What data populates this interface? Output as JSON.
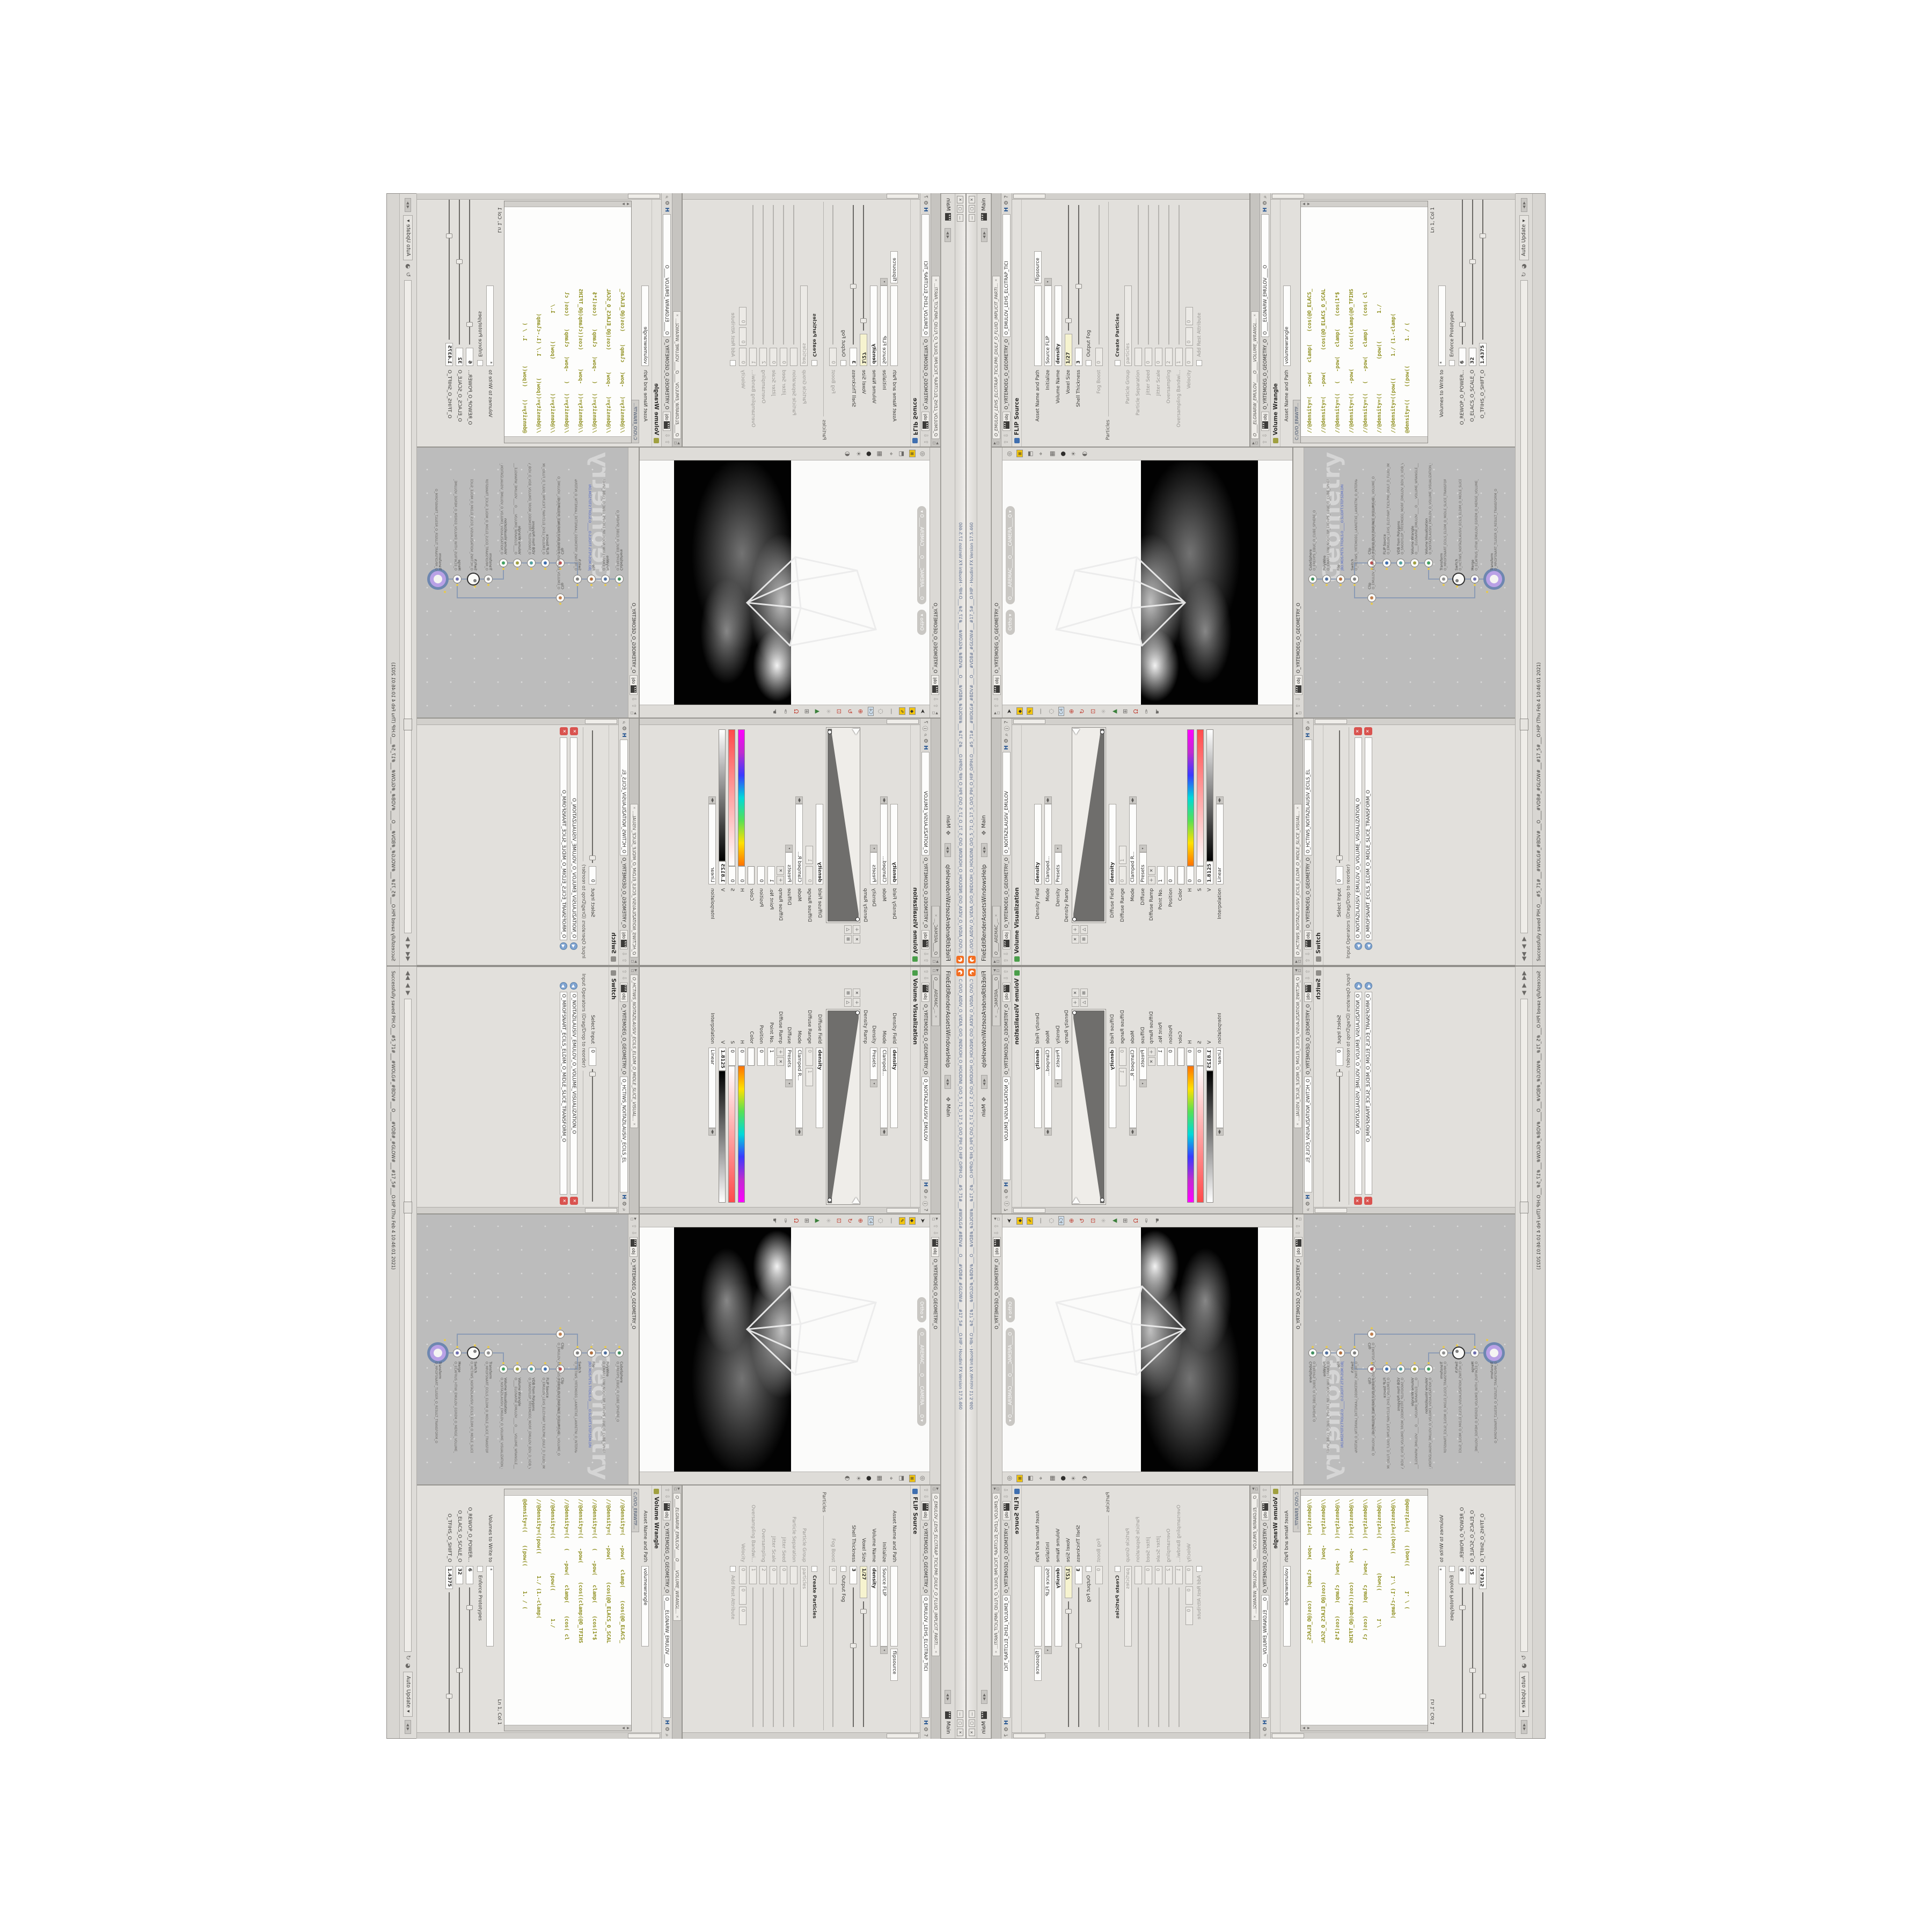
{
  "colors": {
    "accent_orange": "#f26d21",
    "node_purple": "#b9a1e6",
    "node_ring_blue": "#6e87b0",
    "code_text": "#8f8f1f",
    "yellow_field": "#f6f3cf",
    "title_text": "#5a6b8c",
    "network_bg": "#bcbcbc"
  },
  "window": {
    "title": "C:/O/O_AIDIV_O_VIDIA_O/O_INIDUOH_O_HOUDINI_O/O_5_71_O_17_5_O/O_PIH_O_HIP_O/PIH.O___#5_71#___#WOLG#_#BDV#___O___#VDB#_#GLOW#___#17_5#___O.HIP - Houdini FX Version 17.5.460",
    "menus": [
      "File",
      "Edit",
      "Render",
      "Assets",
      "Windows",
      "Help"
    ],
    "desktop_label": "Main",
    "take_label": "Main",
    "btn_min": "—",
    "btn_max": "▢",
    "btn_close": "✕"
  },
  "viz_pane": {
    "tabs": [
      "O____ARTNAM_...",
      "O____AREMAC_...",
      "O_NOITAZILAUSIV..."
    ],
    "context": "obj",
    "crumb": "O_YRTEMOEG_O_GEOMETRY_O",
    "pathfield": "O_NOITAZILAUSIV_EMULOV",
    "header": "Volume Visualization",
    "density_field_label": "Density Field",
    "density_field": "density",
    "mode_label": "Mode",
    "mode": "Clamped...",
    "density_label": "Density",
    "presets": "Presets",
    "density_ramp_label": "Density Ramp",
    "diffuse_field_label": "Diffuse Field",
    "diffuse_field": "density",
    "diffuse_range_label": "Diffuse Range",
    "diffuse_range_min": "0",
    "diffuse_range_max": "1",
    "mode2_label": "Mode",
    "mode2": "Clamped R...",
    "diffuse_label": "Diffuse",
    "presets2": "Presets",
    "diffuse_ramp_label": "Diffuse Ramp",
    "point_label": "Point No.",
    "point": "1",
    "position_label": "Position",
    "position": "0",
    "color_label": "Color",
    "h_label": "H",
    "h": "0",
    "s_label": "S",
    "s": "0",
    "v_label": "V",
    "v": "1.8125",
    "interp_label": "Interpolation",
    "interp": "Linear"
  },
  "switch_pane": {
    "tab": "O_HCTIWS_NOITAZILAUSIV_ECILS_ELDIM_O_MIDLE_SLICE_VISUAL...",
    "context": "obj",
    "crumb": "O_YRTEMOEG_O_GEOMETRY_O",
    "pathfield": "O_HCTIWS_NOITAZILAUSIV_ECILS_EL",
    "header": "Switch",
    "select_label": "Select Input",
    "select": "0",
    "ops_label": "Input Operators (Drag/Drop to reorder)",
    "items": [
      "O_NOITAZILAUSIV_EMULOV_O_VOLUME_VISUALIZATION_O",
      "O_MROFSNART_ECILS_ELDIM_O_MIDLE_SLICE_TRANSFORM_O"
    ]
  },
  "viewport": {
    "context": "obj",
    "crumb": "O_YRTEMOEG_O_GEOMETRY_O",
    "ortho_pill": "Ortho ▾",
    "camera_pill": "O____AREMAC____O____CAMERA____O ▾"
  },
  "network": {
    "context": "obj",
    "crumb": "O_YRTEMOEG_O_GEOMETRY_O",
    "watermark": "Geometry",
    "nodes": [
      {
        "style": "left:250px;top:8px",
        "cls": "node",
        "mini": "#3f8f5f",
        "type": "CubeSphere",
        "name": "O_EREHPS_EBUC_O_CUBE_SPHERE_O",
        "name_style": ""
      },
      {
        "style": "left:250px;top:34px",
        "cls": "node",
        "mini": "#4f6f9f",
        "type": "PolyWire",
        "name": "O_EMARFERIW_NOGYLOP_EREHPS_EBUC_O_CUBE_SPHERE_POLYGON_WIREFRAME_O",
        "name_style": ""
      },
      {
        "style": "left:250px;top:60px",
        "cls": "node",
        "mini": "#b06f3f",
        "type": "File",
        "name": "JBD.MDS.PETS.TFIDILS.O_____O.SLIDIFT.STEP.SDM.DRI",
        "name_style": "color:#4a62c8"
      },
      {
        "style": "left:250px;top:86px",
        "cls": "node",
        "mini": "#7f7f7f",
        "type": "Switch",
        "name": "O_HCTIWS_YRTEMOEG_LANRETXE_LANRETNI_O_INTERNAL_EXTERNAL_GEOMETRY_SWITCH_O",
        "name_style": ""
      },
      {
        "style": "left:280px;top:118px",
        "cls": "node",
        "mini": "#c05050",
        "type": "Clip",
        "name": "O_EMULOV_LEHS_PILC_O_CLIP_SHEL_VOLUME_O",
        "name_style": ""
      },
      {
        "style": "left:215px;top:118px",
        "cls": "node",
        "mini": "#c08050",
        "type": "Clip",
        "name": "O_EMULOV_ECAFRUS_PILC_O_CLIP_SURFACE_VOLUME_O",
        "name_style": ""
      },
      {
        "style": "left:280px;top:146px",
        "cls": "node",
        "mini": "#3f6fb0",
        "type": "FLIP Source",
        "name": "O_EMULOV_LEHS_ELCITRAP_TICILPMI_DIULF_D_FLUID_IMPLICIT_PARTICLE_SHEL_VOLUME_O",
        "name_style": ""
      },
      {
        "style": "left:280px;top:172px",
        "cls": "node",
        "mini": "#50a0a0",
        "type": "VDB from Polygons",
        "name": "O_SNOGYLOP_YRTEMOEG_MORF_EMULOV_BDV_D_VDB_VOLUME_FROM_GEOMETRY_POLYGONS_O",
        "name_style": ""
      },
      {
        "style": "left:280px;top:198px",
        "cls": "node",
        "mini": "#a0a040",
        "type": "Volume Wrangle",
        "name": "O____ELGNARW_EMULOV____O____VOLUME_WRANGLE____O2",
        "name_style": ""
      },
      {
        "style": "left:280px;top:224px",
        "cls": "node",
        "mini": "#40a060",
        "type": "Volume Visualization",
        "name": "O_NOITAZILAUSIV_EMULOV_O_VOLUME_VISUALIZATION_O",
        "name_style": ""
      },
      {
        "style": "left:250px;top:252px",
        "cls": "node",
        "mini": "#8f8f8f",
        "type": "Transform",
        "name": "O_MROFSNART_ECILS_ELDIM_O_MIDLE_SLICE_TRANSFORM_O",
        "name_style": ""
      },
      {
        "style": "left:250px;top:280px",
        "cls": "node ring",
        "mini": "#7f7f7f",
        "type": "Switch",
        "name": "O_HCTIWS_NOITAZILAUSIV_ECILS_ELDIM_O_MIDLE_SLICE_VISUALIZATION_SWITCH_O",
        "name_style": ""
      },
      {
        "style": "left:250px;top:310px",
        "cls": "node",
        "mini": "#6f6fb0",
        "type": "Merge",
        "name": "O_ECAFRUS_HTIW_EMULOV_EGREM_O_MERGE_VOLUME_WITH_SURFACE_O",
        "name_style": ""
      },
      {
        "style": "left:250px;top:346px",
        "cls": "node big",
        "mini": "",
        "type": "Transform",
        "name": "O_MROFSNART_TLUSER_O_RESULT_TRANSFORM_O",
        "name_style": ""
      }
    ],
    "wires": [
      [
        0,
        1
      ],
      [
        1,
        2
      ],
      [
        2,
        3
      ],
      [
        3,
        4
      ],
      [
        3,
        5
      ],
      [
        4,
        6
      ],
      [
        6,
        7
      ],
      [
        7,
        8
      ],
      [
        8,
        9
      ],
      [
        9,
        10
      ],
      [
        10,
        11
      ],
      [
        11,
        12
      ],
      [
        12,
        13
      ],
      [
        5,
        12
      ]
    ]
  },
  "flip_pane": {
    "tab": "O_EMULOV_LEHS_ELCITRAP_TICILPMI_DIULF_O_FLUID_IMPLICIT_PARTI...",
    "context": "obj",
    "crumb": "O_YRTEMOEG_O_GEOMETRY_O",
    "pathfield": "O_EMULOV_LEHS_ELCITRAP_TICI",
    "header": "FLIP Source",
    "asset_label": "Asset Name and Path",
    "asset_value": "",
    "asset_value2": "flipsource",
    "initialize_label": "Initialize",
    "initialize": "Source FLIP",
    "volume_name_label": "Volume Name",
    "volume_name": "density",
    "voxel_size_label": "Voxel Size",
    "voxel_size": "1/27",
    "shell_label": "Shell Thickness",
    "shell": "3",
    "output_fog_label": "Output Fog",
    "fog_boost_label": "Fog Boost",
    "fog_boost": "0",
    "particles_section": "Particles",
    "create_particles_label": "Create Particles",
    "particle_group_label": "Particle Group",
    "particle_group": "particles",
    "particle_sep_label": "Particle Separation",
    "particle_sep": "",
    "jitter_seed_label": "Jitter Seed",
    "jitter_seed": "0",
    "jitter_scale_label": "Jitter Scale",
    "jitter_scale": "0",
    "oversampling_label": "Oversampling",
    "oversampling": "2",
    "oversampling_bw_label": "Oversampling Bandwi...",
    "oversampling_bw": "1",
    "velocity_label": "Velocity",
    "vx": "0",
    "vy": "0",
    "vz": "0",
    "add_rest_label": "Add Rest Attribute"
  },
  "wrangle_pane": {
    "tab": "O____ELGNARW_EMULOV____O____VOLUME_WRANGL...",
    "context": "obj",
    "crumb": "O_YRTEMOEG_O_GEOMETRY_O",
    "pathfield": "O____ELGNARW_EMULOV____O",
    "header": "Volume Wrangle",
    "asset_label": "Asset Name and Path",
    "asset_value": "volumewrangle",
    "file_tab": "C:/O/O_ERAWTF...",
    "code": [
      "//@density=(   -pow(   clamp(    (cos(@O_ELACS_",
      "//@density=(   -pow(       (cos(@O_ELACS_O_SCAL",
      "//@density=((   (   -pow(   clamp(    (cos(1*$",
      "//@density=((   -pow(      (cos((clamp(@O_TFIHS",
      "//@density=((   (   -pow(   clamp(    (cos( cl",
      "//@density=((           (pow((         1./",
      "//@density=((pow((       1./ (1.-clamp(",
      "@density=((    ((pow((        1. / ("
    ],
    "volumes_label": "Volumes to Write to",
    "volumes": "*",
    "enforce_label": "Enforce Prototypes",
    "sliders": [
      {
        "label": "O_REWOP_O_POWER...",
        "value": "6"
      },
      {
        "label": "O_ELACS_O_SCALE_O",
        "value": "32"
      },
      {
        "label": "O_TFIHS_O_SHIFT_O",
        "value": "1.4375"
      }
    ],
    "lncol": "Ln 1, Col 1"
  },
  "playbar": {
    "auto_update": "Auto Update"
  },
  "statusbar": {
    "text": "Successfully saved PIH.O___#5_71#___#WOLG#_#BDV#___O____#VDB#_#GLOW#___#17_5#___O.HIP  (Thu Feb 4 10:46:01 2021)"
  }
}
